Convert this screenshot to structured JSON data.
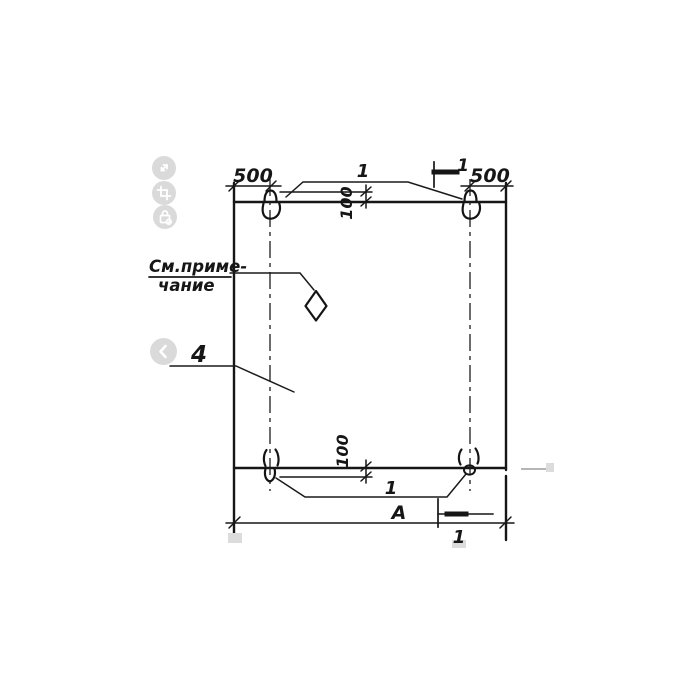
{
  "viewer": {
    "buttons": [
      {
        "name": "expand-icon"
      },
      {
        "name": "crop-icon"
      },
      {
        "name": "lock-icon"
      },
      {
        "name": "prev-icon"
      }
    ],
    "button_color": "#d4d4d4"
  },
  "drawing": {
    "ink_color": "#161616",
    "labels": {
      "dim_top_left": "500",
      "dim_top_right": "500",
      "dim_loop_top": "100",
      "dim_loop_bottom": "100",
      "callout_loops_top": "1",
      "callout_loops_bottom": "1",
      "section_mark_top": "1",
      "section_mark_bottom": "1",
      "part_number": "4",
      "overall_width": "А",
      "note_line1": "См.приме-",
      "note_line2": "чание"
    }
  }
}
